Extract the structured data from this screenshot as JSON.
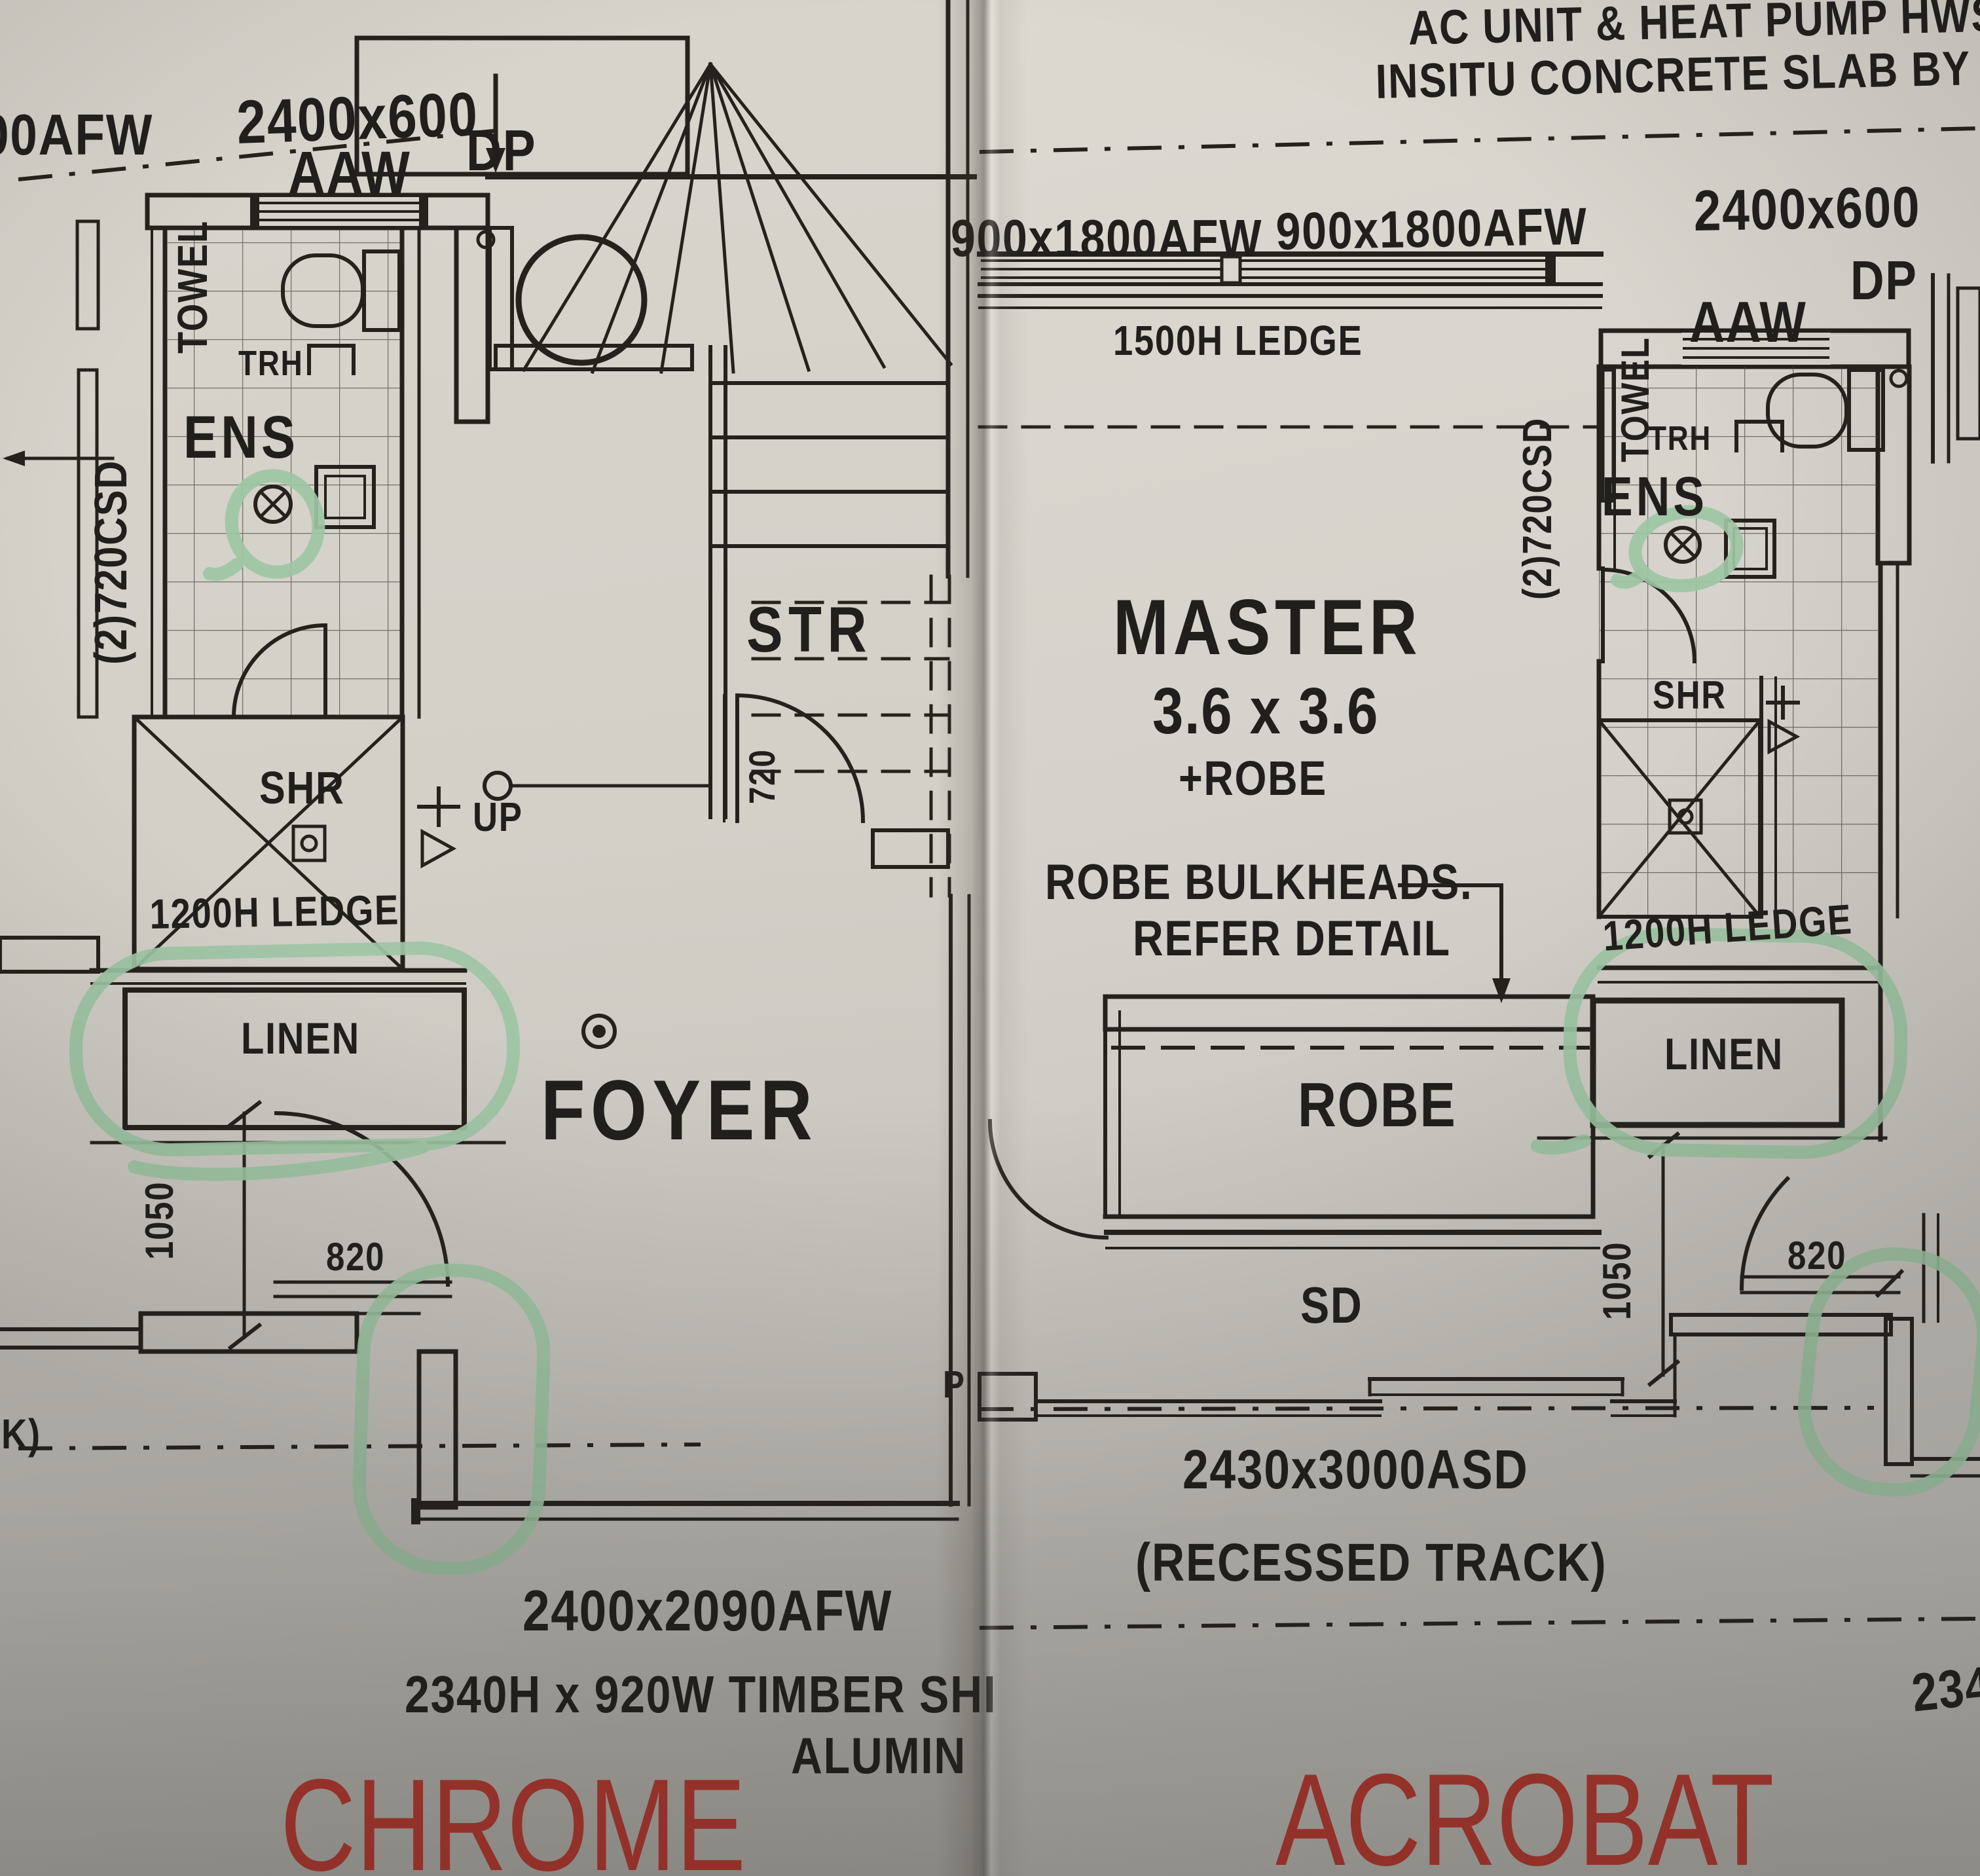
{
  "comparison": {
    "left": {
      "caption": "CHROME",
      "labels": {
        "partial_afw": "00AFW",
        "window_top": "2400x600",
        "aaw": "AAW",
        "dp": "DP",
        "towel": "TOWEL",
        "trh": "TRH",
        "room_ens": "ENS",
        "csd": "(2)720CSD",
        "shr": "SHR",
        "ledge_1200": "1200H LEDGE",
        "linen": "LINEN",
        "up": "UP",
        "dim_720": "720",
        "room_str": "STR",
        "room_foyer": "FOYER",
        "dim_1050": "1050",
        "dim_820": "820",
        "window_bottom": "2400x2090AFW",
        "note_timber": "2340H x 920W TIMBER SHI",
        "note_alumin": "ALUMIN",
        "partial_k": "K)"
      }
    },
    "right": {
      "caption": "ACROBAT",
      "labels": {
        "note_ac1": "AC UNIT & HEAT PUMP HWS ON-",
        "note_ac2": "INSITU CONCRETE SLAB BY BUILDER",
        "afw_a": "900x1800AFW",
        "afw_b": "900x1800AFW",
        "window_top": "2400x600",
        "aaw": "AAW",
        "dp": "DP",
        "ledge_1500": "1500H LEDGE",
        "towel": "TOWEL",
        "trh": "TRH",
        "room_ens": "ENS",
        "csd": "(2)720CSD",
        "room_master": "MASTER",
        "master_size": "3.6 x 3.6",
        "master_plus": "+ROBE",
        "bulkheads_1": "ROBE BULKHEADS.",
        "bulkheads_2": "REFER DETAIL",
        "shr": "SHR",
        "robe": "ROBE",
        "ledge_1200": "1200H LEDGE",
        "linen": "LINEN",
        "dim_1050": "1050",
        "dim_820": "820",
        "sd": "SD",
        "door_sd": "2430x3000ASD",
        "recessed": "(RECESSED TRACK)",
        "dim_2340": "2340",
        "partial_p": "P"
      }
    }
  },
  "symbols": {
    "floor_waste_icon": "circled-x",
    "shower_drain_icon": "square-with-dot",
    "foyer_target_icon": "double-circle-dot",
    "down_arrow_icon": "filled-down-arrow",
    "door_swing": "quarter-arc"
  },
  "colors": {
    "highlighter_green": "#9dc6a4",
    "caption_red": "#b7372f",
    "ink": "#25221d",
    "paper": "#d4d1c9"
  }
}
